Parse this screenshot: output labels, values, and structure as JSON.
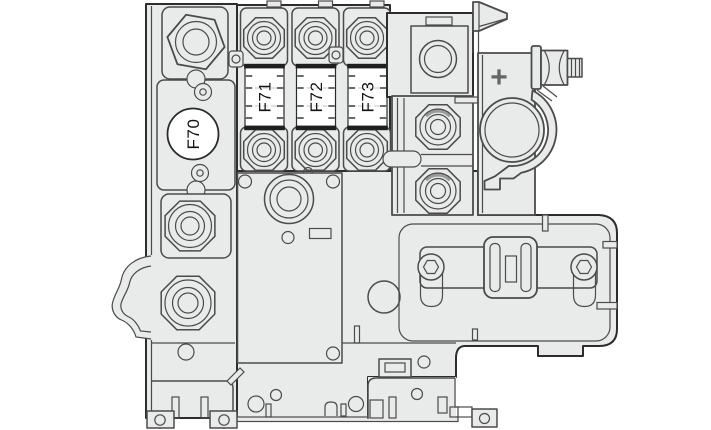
{
  "figure": {
    "description": "Line-art diagram of a battery-mounted fuse box with positive terminal clamp"
  },
  "labels": {
    "fuse_f70": "F70",
    "fuse_f71": "F71",
    "fuse_f72": "F72",
    "fuse_f73": "F73",
    "positive_terminal": "+"
  },
  "colors": {
    "background": "#ffffff",
    "body_fill": "#e9eaea",
    "fuse_fill": "#ffffff",
    "outline": "#2d2d2d",
    "line": "#4b4b4b",
    "band_dark": "#1f1f1f",
    "dash_light": "#c6c6c6",
    "text": "#141414",
    "plus_gray": "#666666"
  }
}
